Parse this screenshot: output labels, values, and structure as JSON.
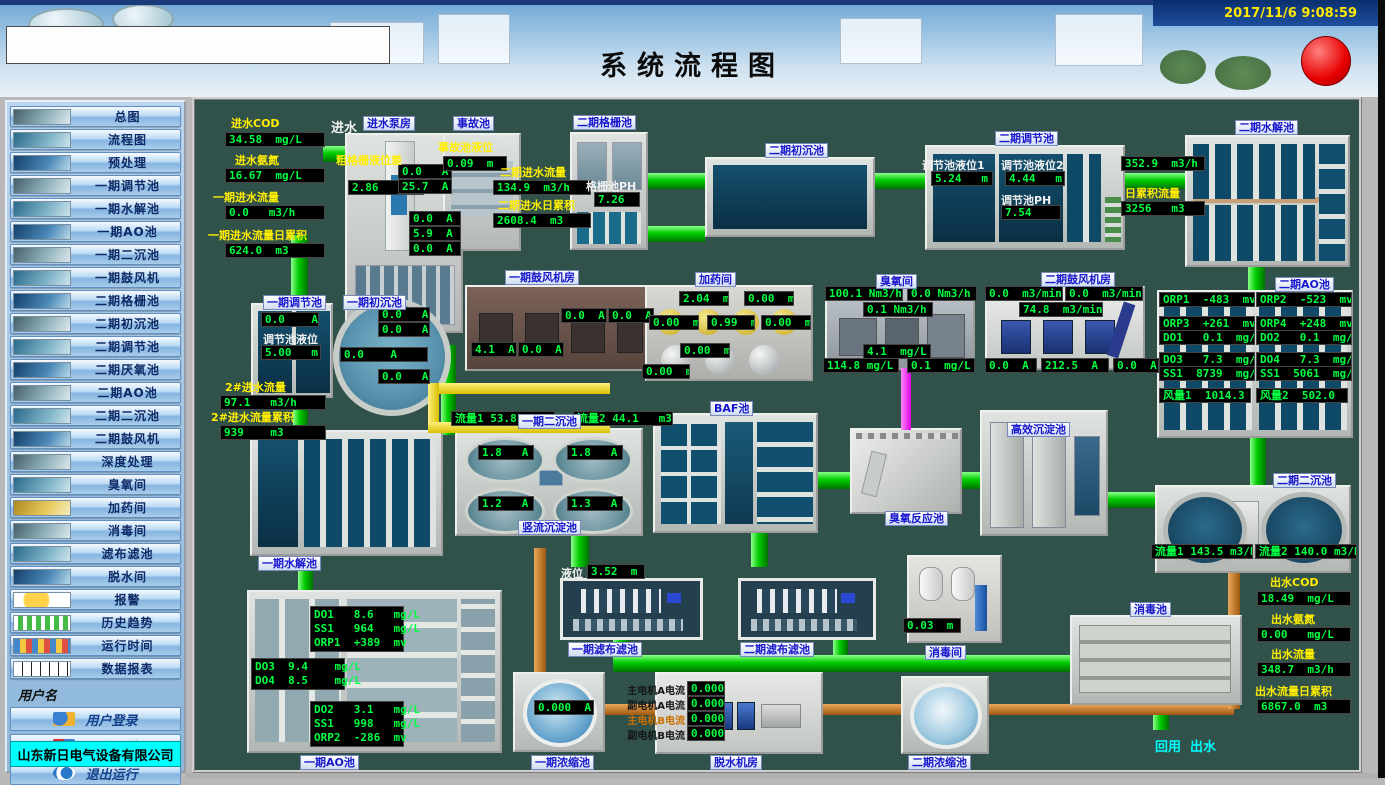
{
  "window": {
    "datetime": "2017/11/6 9:08:59",
    "title": "系统流程图"
  },
  "colors": {
    "value_green": "#00ff41",
    "label_yellow": "#ffee00",
    "pipe_green": "#00cc00",
    "pipe_orange": "#b06a18",
    "pipe_yellow": "#e0cc00",
    "pipe_magenta": "#ff00ff",
    "alarm_red": "#e80000",
    "company_bg": "#00ffff"
  },
  "sidebar": {
    "items": [
      "总图",
      "流程图",
      "预处理",
      "一期调节池",
      "一期水解池",
      "一期AO池",
      "一期二沉池",
      "一期鼓风机",
      "二期格栅池",
      "二期初沉池",
      "二期调节池",
      "二期厌氧池",
      "二期AO池",
      "二期二沉池",
      "二期鼓风机",
      "深度处理",
      "臭氧间",
      "加药间",
      "消毒间",
      "滤布滤池",
      "脱水间",
      "报警",
      "历史趋势",
      "运行时间",
      "数据报表"
    ],
    "username_label": "用户名",
    "login": "用户登录",
    "logout": "用户注销",
    "exit": "退出运行",
    "company": "山东新日电气设备有限公司"
  },
  "inlet": {
    "flow_in_label": "进水",
    "cod_label": "进水COD",
    "cod": "34.58  mg/L",
    "nh3_label": "进水氨氮",
    "nh3": "16.67  mg/L",
    "flow_label": "一期进水流量",
    "flow": "0.0   m3/h",
    "acc_label": "一期进水流量日累积",
    "acc": "624.0  m3"
  },
  "pump_house": {
    "label": "进水泵房",
    "screen_label": "粗格栅液位差",
    "screen_level": "2.86   m",
    "currents": [
      "0.0   A",
      "25.7  A",
      "0.0  A",
      "5.9  A",
      "0.0  A"
    ]
  },
  "accident": {
    "label": "事故池",
    "level_label": "事故池液位",
    "level": "0.09  m"
  },
  "p2_inflow": {
    "flow_label": "二期进水流量",
    "flow": "134.9  m3/h",
    "acc_label": "二期进水日累积",
    "acc": "2608.4  m3"
  },
  "grille": {
    "label": "二期格栅池",
    "ph_label": "格栅池PH",
    "ph": "7.26"
  },
  "p2_primary": {
    "label": "二期初沉池"
  },
  "p2_reg": {
    "label": "二期调节池",
    "lv1_label": "调节池液位1",
    "lv1": "5.24   m",
    "lv2_label": "调节池液位2",
    "lv2": "4.44   m",
    "ph_label": "调节池PH",
    "ph": "7.54"
  },
  "p2_hyd": {
    "label": "二期水解池",
    "flow": "352.9  m3/h",
    "acc_label": "日累积流量",
    "acc": "3256   m3"
  },
  "p1_reg": {
    "label": "一期调节池",
    "current": "0.0    A",
    "lv_label": "调节池液位",
    "lv": "5.00   m"
  },
  "p1_primary": {
    "label": "一期初沉池",
    "currents": [
      "0.0   A",
      "0.0   A",
      "0.0    A",
      "0.0   A"
    ]
  },
  "inflow2": {
    "flow_label": "2#进水流量",
    "flow": "97.1   m3/h",
    "acc_label": "2#进水流量累积",
    "acc": "939    m3"
  },
  "p1_blower": {
    "label": "一期鼓风机房",
    "currents": [
      "0.0  A",
      "0.0  A",
      "4.1  A",
      "0.0  A"
    ]
  },
  "dosing": {
    "label": "加药间",
    "levels": [
      "2.04  m",
      "0.00  m",
      "0.00  m",
      "0.99  m",
      "0.00  m",
      "0.00  m",
      "0.00  m"
    ]
  },
  "ozone": {
    "label": "臭氧间",
    "values": [
      "100.1 Nm3/h",
      "0.0 Nm3/h",
      "0.1 Nm3/h",
      "4.1  mg/L",
      "114.8 mg/L",
      "0.1  mg/L"
    ]
  },
  "p2_blower": {
    "label": "二期鼓风机房",
    "flows": [
      "0.0  m3/min",
      "0.0  m3/min",
      "74.8  m3/min"
    ],
    "currents": [
      "0.0  A",
      "212.5  A",
      "0.0  A"
    ]
  },
  "p2_ao": {
    "label": "二期AO池",
    "left": [
      "ORP1  -483  mv",
      "ORP3  +261  mv",
      "DO1   0.1  mg/L",
      "DO3   7.3  mg/L",
      "SS1  8739  mg/L",
      "风量1  1014.3"
    ],
    "right": [
      "ORP2  -523  mv",
      "ORP4  +248  mv",
      "DO2   0.1  mg/L",
      "DO4   7.3  mg/L",
      "SS1  5061  mg/L",
      "风量2  502.0"
    ]
  },
  "p1_sec": {
    "label": "一期二沉池",
    "flow1": "流量1 53.8   m3/h",
    "flow2": "流量2 44.1   m3/h",
    "currents": [
      "1.8   A",
      "1.8   A",
      "1.2   A",
      "1.3   A"
    ],
    "sublabel": "竖流沉淀池"
  },
  "p1_hyd": {
    "label": "一期水解池"
  },
  "baf": {
    "label": "BAF池"
  },
  "ozone_reactor": {
    "label": "臭氧反应池"
  },
  "hes": {
    "label": "高效沉淀池"
  },
  "p2_sec": {
    "label": "二期二沉池",
    "flow1": "流量1 143.5 m3/h",
    "flow2": "流量2 140.0 m3/h"
  },
  "outlet": {
    "cod_label": "出水COD",
    "cod": "18.49  mg/L",
    "nh3_label": "出水氨氮",
    "nh3": "0.00   mg/L",
    "flow_label": "出水流量",
    "flow": "348.7  m3/h",
    "acc_label": "出水流量日累积",
    "acc": "6867.0  m3"
  },
  "p1_ao": {
    "label": "一期AO池",
    "box1": [
      "DO1   8.6   mg/L",
      "SS1   964   mg/L",
      "ORP1  +389  mv"
    ],
    "box2": [
      "DO3  9.4    mg/L",
      "DO4  8.5    mg/L"
    ],
    "box3": [
      "DO2   3.1   mg/L",
      "SS1   998   mg/L",
      "ORP2  -286  mv"
    ]
  },
  "p1_filter": {
    "label": "一期滤布滤池",
    "lv_label": "液位",
    "lv": "3.52  m"
  },
  "p2_filter": {
    "label": "二期滤布滤池"
  },
  "disinfect_room": {
    "label": "消毒间",
    "level": "0.03  m"
  },
  "disinfect_tank": {
    "label": "消毒池"
  },
  "p1_thickener": {
    "label": "一期浓缩池",
    "current": "0.000  A"
  },
  "dewatering": {
    "label": "脱水机房",
    "rows": [
      {
        "label": "主电机A电流",
        "value": "0.000"
      },
      {
        "label": "副电机A电流",
        "value": "0.000"
      },
      {
        "label": "主电机B电流",
        "value": "0.000"
      },
      {
        "label": "副电机B电流",
        "value": "0.000"
      }
    ]
  },
  "p2_thickener": {
    "label": "二期浓缩池"
  },
  "reuse": {
    "label": "回用  出水"
  }
}
